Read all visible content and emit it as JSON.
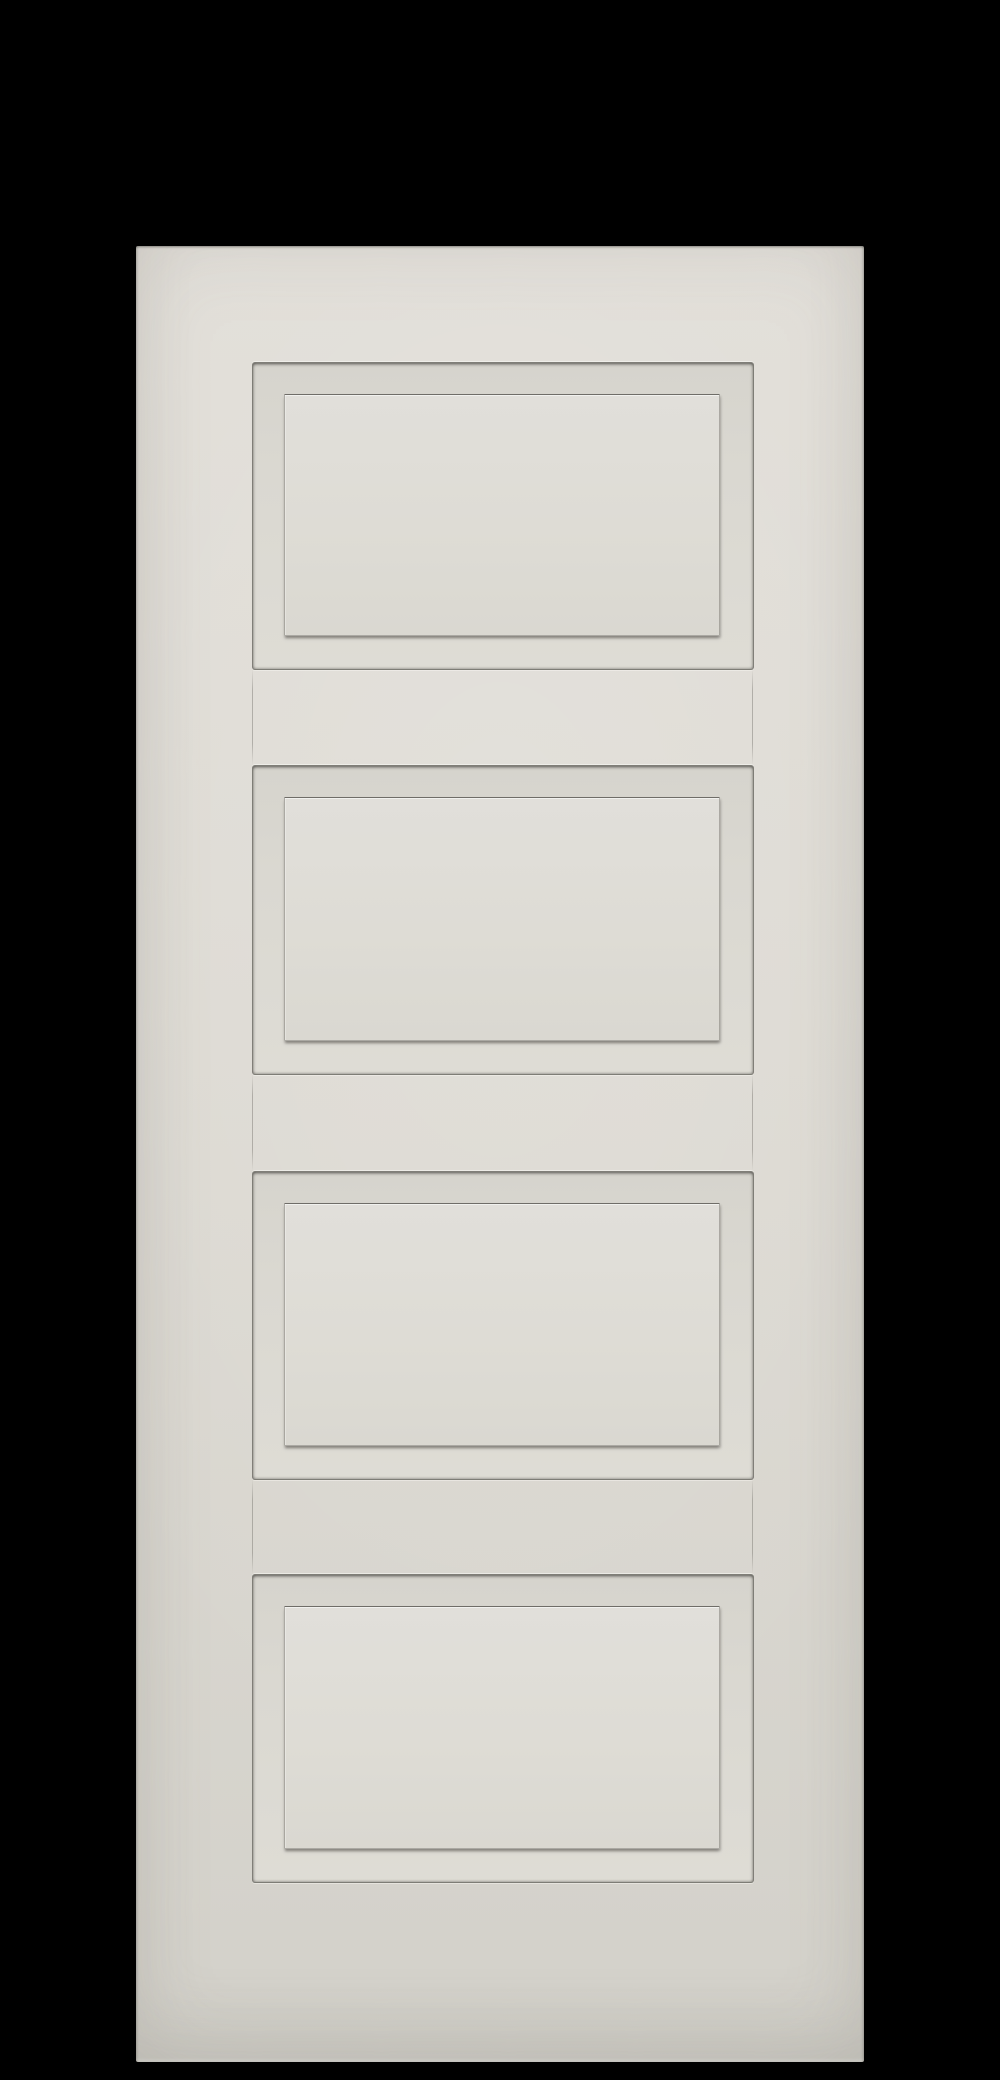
{
  "scene": {
    "description": "Off-white four-panel shaker style interior door photographed straight-on against a solid black background",
    "subject": "four-panel interior door",
    "panel_count": 4,
    "panels": [
      {
        "label": "top panel"
      },
      {
        "label": "upper middle panel"
      },
      {
        "label": "lower middle panel"
      },
      {
        "label": "bottom panel"
      }
    ]
  },
  "colors": {
    "background": "#000000",
    "door_face": "#dcd9d2",
    "door_face_light": "#e2dfd9",
    "door_face_dark": "#d3d1ca",
    "raised_face": "#dedcd5",
    "raised_face_light": "#e1dfda",
    "groove_shadow": "#6f6d68",
    "highlight": "#faf9f5"
  }
}
